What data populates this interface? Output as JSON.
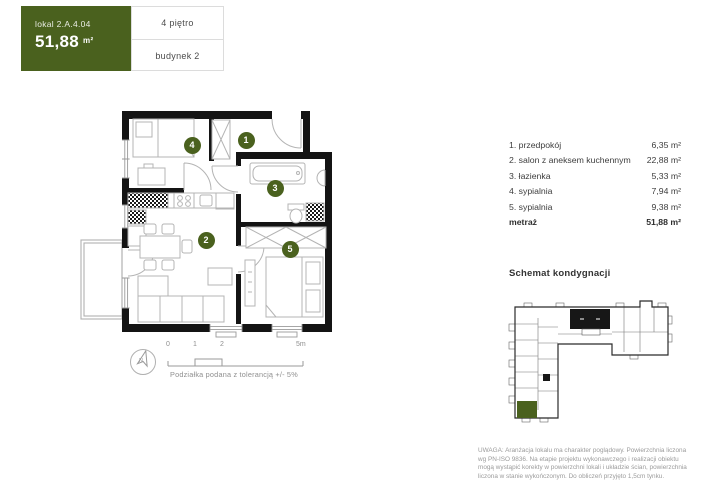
{
  "header": {
    "unit_label": "lokal 2.A.4.04",
    "area_value": "51,88",
    "area_unit": "m²",
    "floor": "4 piętro",
    "building": "budynek 2"
  },
  "plan": {
    "badges": [
      "1",
      "2",
      "3",
      "4",
      "5"
    ],
    "compass_label": "N"
  },
  "room_list": {
    "items": [
      {
        "name": "1. przedpokój",
        "area": "6,35 m²"
      },
      {
        "name": "2. salon z aneksem kuchennym",
        "area": "22,88 m²"
      },
      {
        "name": "3. łazienka",
        "area": "5,33 m²"
      },
      {
        "name": "4. sypialnia",
        "area": "7,94 m²"
      },
      {
        "name": "5. sypialnia",
        "area": "9,38 m²"
      }
    ],
    "total_label": "metraż",
    "total_area": "51,88 m²"
  },
  "schematic": {
    "title": "Schemat kondygnacji"
  },
  "scale_bar": {
    "ticks": [
      "0",
      "1",
      "2",
      "5m"
    ],
    "note": "Podziałka podana z tolerancją +/- 5%"
  },
  "disclaimer": {
    "lines": [
      "UWAGA: Aranżacja lokalu ma charakter poglądowy. Powierzchnia liczona",
      "wg PN-ISO 9836. Na etapie projektu wykonawczego i realizacji obiektu",
      "mogą wystąpić korekty w powierzchni lokali i układzie ścian, powierzchnia",
      "liczona w stanie wykończonym. Do obliczeń przyjęto 1,5cm tynku."
    ]
  },
  "colors": {
    "accent_green": "#4a611e",
    "wall_black": "#141414",
    "line_gray": "#b4b4b4",
    "text_dark": "#3d3d3d",
    "text_muted": "#8f8f8f",
    "border_gray": "#dcdcdc"
  }
}
